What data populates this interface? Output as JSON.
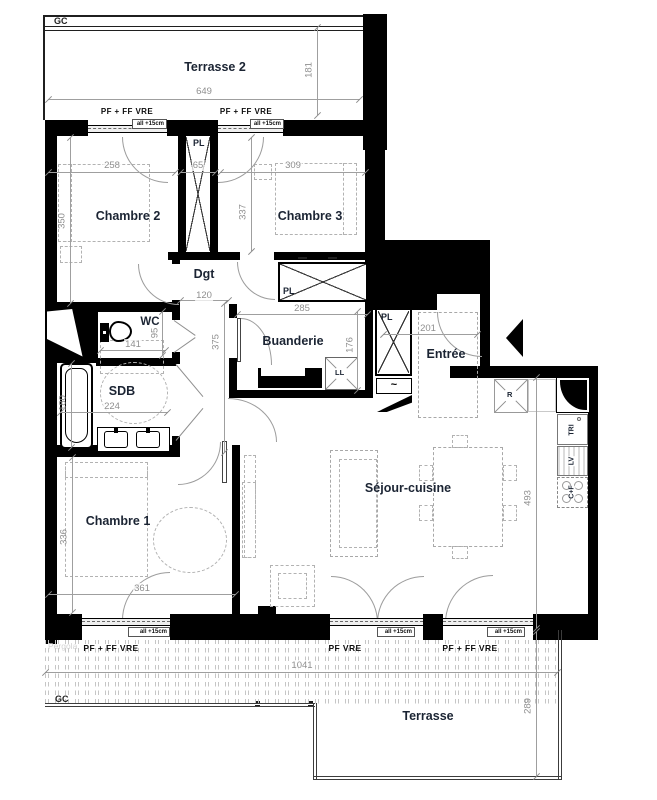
{
  "labels": {
    "terrasse2": "Terrasse 2",
    "chambre2": "Chambre 2",
    "chambre3": "Chambre 3",
    "dgt": "Dgt",
    "wc": "WC",
    "sdb": "SDB",
    "buanderie": "Buanderie",
    "entree": "Entrée",
    "chambre1": "Chambre 1",
    "sejour": "Séjour-cuisine",
    "terrasse": "Terrasse",
    "pergola": "Pergola",
    "gc": "GC"
  },
  "fixtures": {
    "closet": "PL",
    "washer": "LL",
    "fridge": "R",
    "sorting": "TRI",
    "dishwasher": "LV",
    "cooktop_oven": "C+F",
    "heater_squiggle": "~"
  },
  "windows": {
    "pf_ff_vre": "PF + FF  VRE",
    "pf_vre": "PF VRE",
    "allege": "all +15cm"
  },
  "dims": {
    "terrasse2_w": "649",
    "terrasse2_d": "181",
    "chambre2_w": "258",
    "chambre2_d": "350",
    "pl_w": "65",
    "chambre3_w": "309",
    "chambre3_d": "337",
    "dgt_w": "120",
    "buanderie_w": "285",
    "hall_d": "375",
    "wc_w": "141",
    "wc_d": "95",
    "buanderie_d": "176",
    "entree_w": "201",
    "sdb_w": "224",
    "sdb_d": "180",
    "chambre1_d": "336",
    "chambre1_w": "361",
    "sejour_d": "493",
    "terrasse_w": "1041",
    "terrasse_d": "289"
  },
  "colors": {
    "wall": "#000000",
    "dim_text": "#8f8f8f",
    "room_label": "#1b2433",
    "hatch": "#c6c6c6"
  }
}
